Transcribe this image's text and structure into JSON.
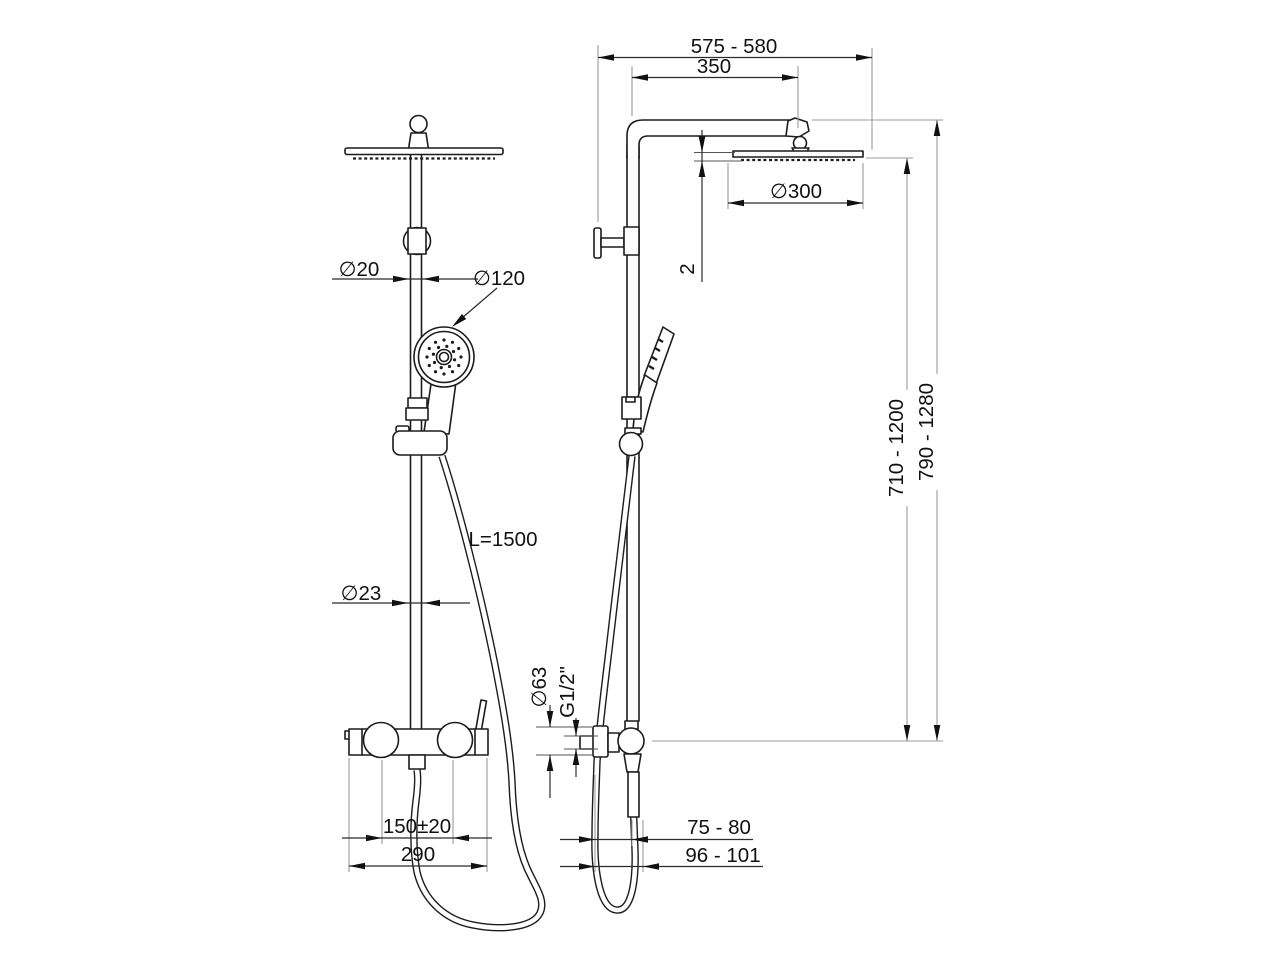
{
  "colors": {
    "object_line": "#1c1c1c",
    "dimension_line": "#2b2b2b",
    "extension_line": "#9b9b9b",
    "background": "#ffffff"
  },
  "front_view": {
    "pole_upper_diameter": "∅20",
    "hand_shower_diameter": "∅120",
    "pole_lower_diameter": "∅23",
    "hose_length": "L=1500",
    "inlet_spacing": "150±20",
    "mixer_width": "290"
  },
  "side_view": {
    "total_depth": "575 - 580",
    "arm_projection": "350",
    "head_diameter": "∅300",
    "head_thickness": "2",
    "height_range_inner": "710 - 1200",
    "height_range_outer": "790 - 1280",
    "escutcheon_diameter": "∅63",
    "connection_thread": "G1/2\"",
    "wall_offset_pole": "75 - 80",
    "wall_offset_hose": "96 - 101"
  }
}
